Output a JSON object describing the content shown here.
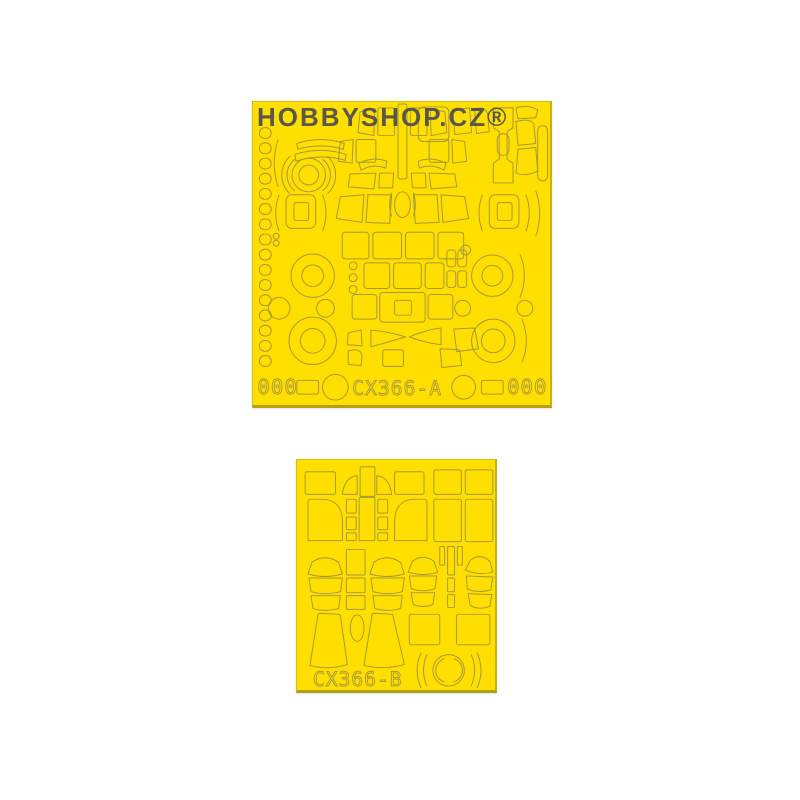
{
  "watermark": "HOBBYSHOP.CZ®",
  "sheet_a": {
    "code": "CX366-A",
    "zeros_left": "000",
    "zeros_right": "000"
  },
  "sheet_b": {
    "code": "CX366-B"
  },
  "colors": {
    "background": "#FFFFFF",
    "sheet_yellow": "#FFDF00",
    "cut_outline_olive": "#A6973C",
    "sheet_edge": "#C9B417",
    "watermark_gray": "#4D4D50"
  }
}
